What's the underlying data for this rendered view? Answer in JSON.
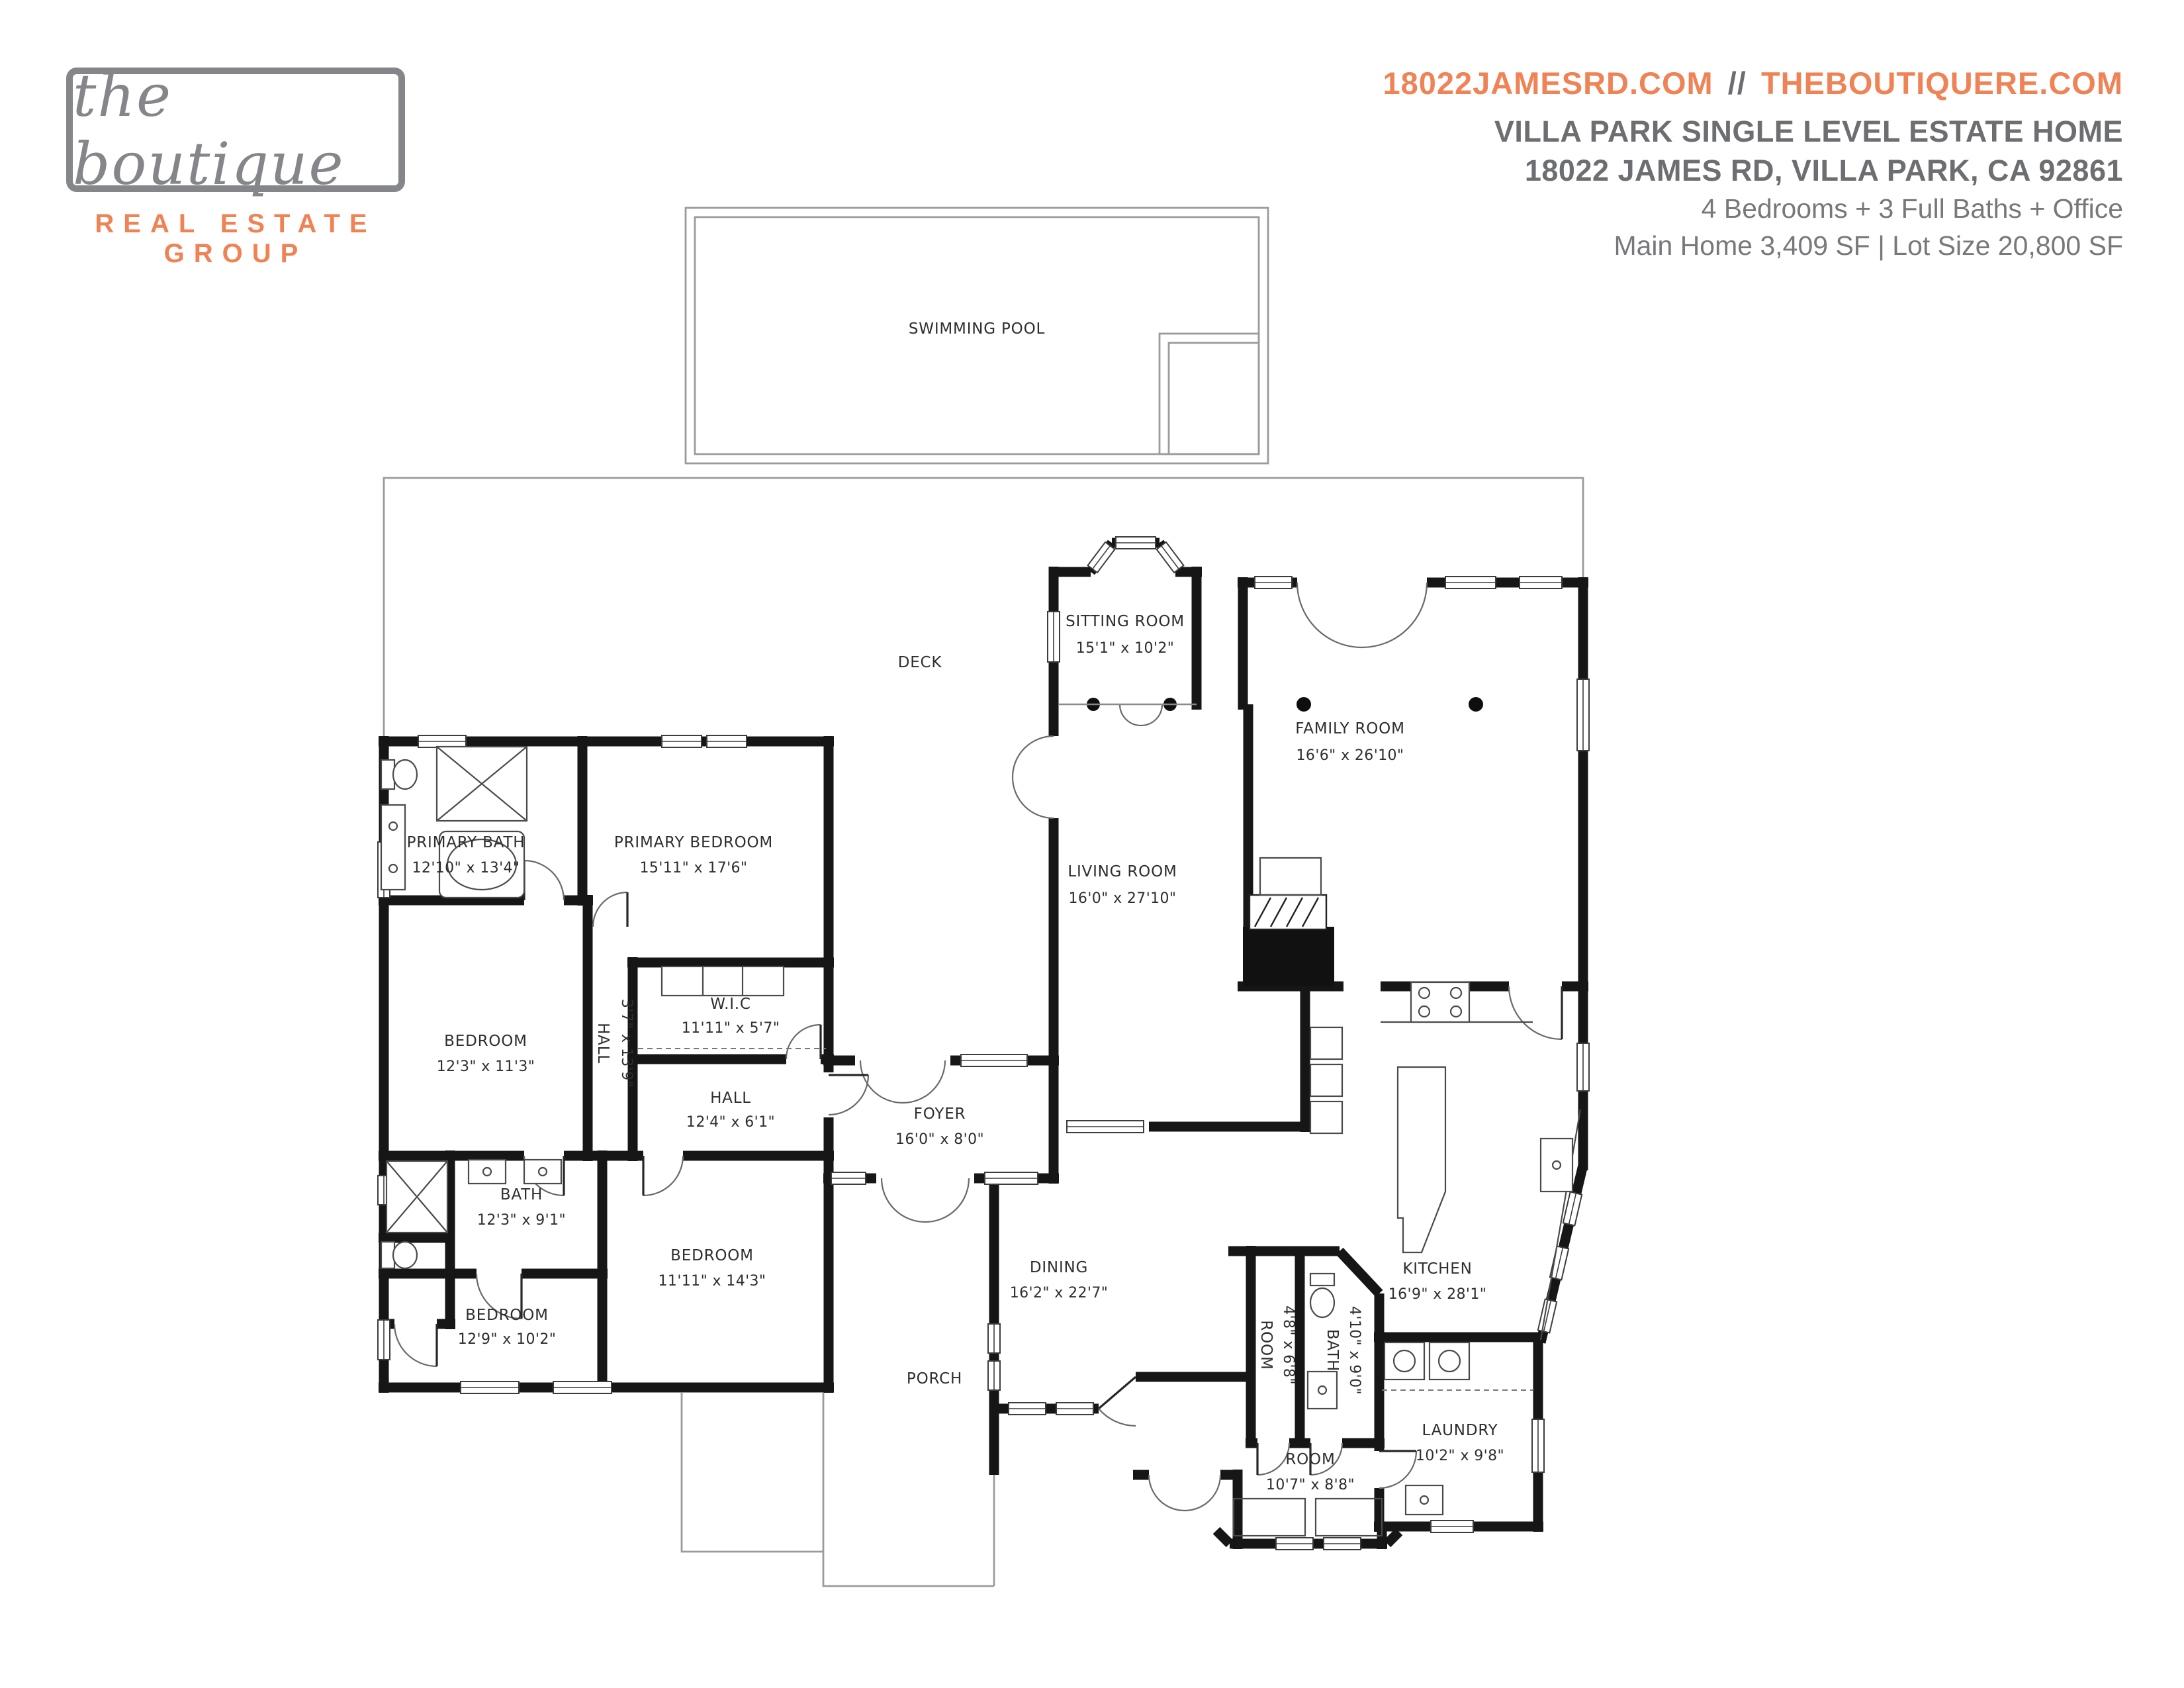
{
  "brand": {
    "name": "the boutique",
    "tagline": "REAL ESTATE GROUP"
  },
  "header": {
    "site_primary": "18022JAMESRD.COM",
    "site_separator": "//",
    "site_secondary": "THEBOUTIQUERE.COM",
    "title": "VILLA PARK SINGLE LEVEL ESTATE HOME",
    "address": "18022 JAMES RD, VILLA PARK, CA 92861",
    "features": "4 Bedrooms + 3 Full Baths + Office",
    "size_info": "Main Home 3,409 SF  |  Lot Size 20,800 SF"
  },
  "colors": {
    "accent": "#EF8355",
    "heading": "#6D6E71",
    "body": "#77787B",
    "logo": "#85868A",
    "wall": "#161616"
  },
  "floorplan": {
    "rooms": {
      "swimming_pool": {
        "name": "SWIMMING POOL",
        "dims": ""
      },
      "deck": {
        "name": "DECK",
        "dims": ""
      },
      "porch": {
        "name": "PORCH",
        "dims": ""
      },
      "sitting": {
        "name": "SITTING ROOM",
        "dims": "15'1\" x 10'2\""
      },
      "family": {
        "name": "FAMILY ROOM",
        "dims": "16'6\" x 26'10\""
      },
      "living": {
        "name": "LIVING ROOM",
        "dims": "16'0\" x 27'10\""
      },
      "primary_bedroom": {
        "name": "PRIMARY BEDROOM",
        "dims": "15'11\" x 17'6\""
      },
      "primary_bath": {
        "name": "PRIMARY BATH",
        "dims": "12'10\" x 13'4\""
      },
      "bedroom_left": {
        "name": "BEDROOM",
        "dims": "12'3\" x 11'3\""
      },
      "wic": {
        "name": "W.I.C",
        "dims": "11'11\" x 5'7\""
      },
      "hall_vertical": {
        "name": "HALL",
        "dims": "3'7\" x 13'9\""
      },
      "hall": {
        "name": "HALL",
        "dims": "12'4\" x 6'1\""
      },
      "foyer": {
        "name": "FOYER",
        "dims": "16'0\" x 8'0\""
      },
      "bath_hall": {
        "name": "BATH",
        "dims": "12'3\" x 9'1\""
      },
      "bedroom_lower_left": {
        "name": "BEDROOM",
        "dims": "12'9\" x 10'2\""
      },
      "bedroom_center": {
        "name": "BEDROOM",
        "dims": "11'11\" x 14'3\""
      },
      "dining": {
        "name": "DINING",
        "dims": "16'2\" x 22'7\""
      },
      "kitchen": {
        "name": "KITCHEN",
        "dims": "16'9\" x 28'1\""
      },
      "room_small": {
        "name": "ROOM",
        "dims": "4'8\" x 6'8\""
      },
      "bath_small": {
        "name": "BATH",
        "dims": "4'10\" x 9'0\""
      },
      "room_rear": {
        "name": "ROOM",
        "dims": "10'7\" x 8'8\""
      },
      "laundry": {
        "name": "LAUNDRY",
        "dims": "10'2\" x 9'8\""
      }
    }
  }
}
